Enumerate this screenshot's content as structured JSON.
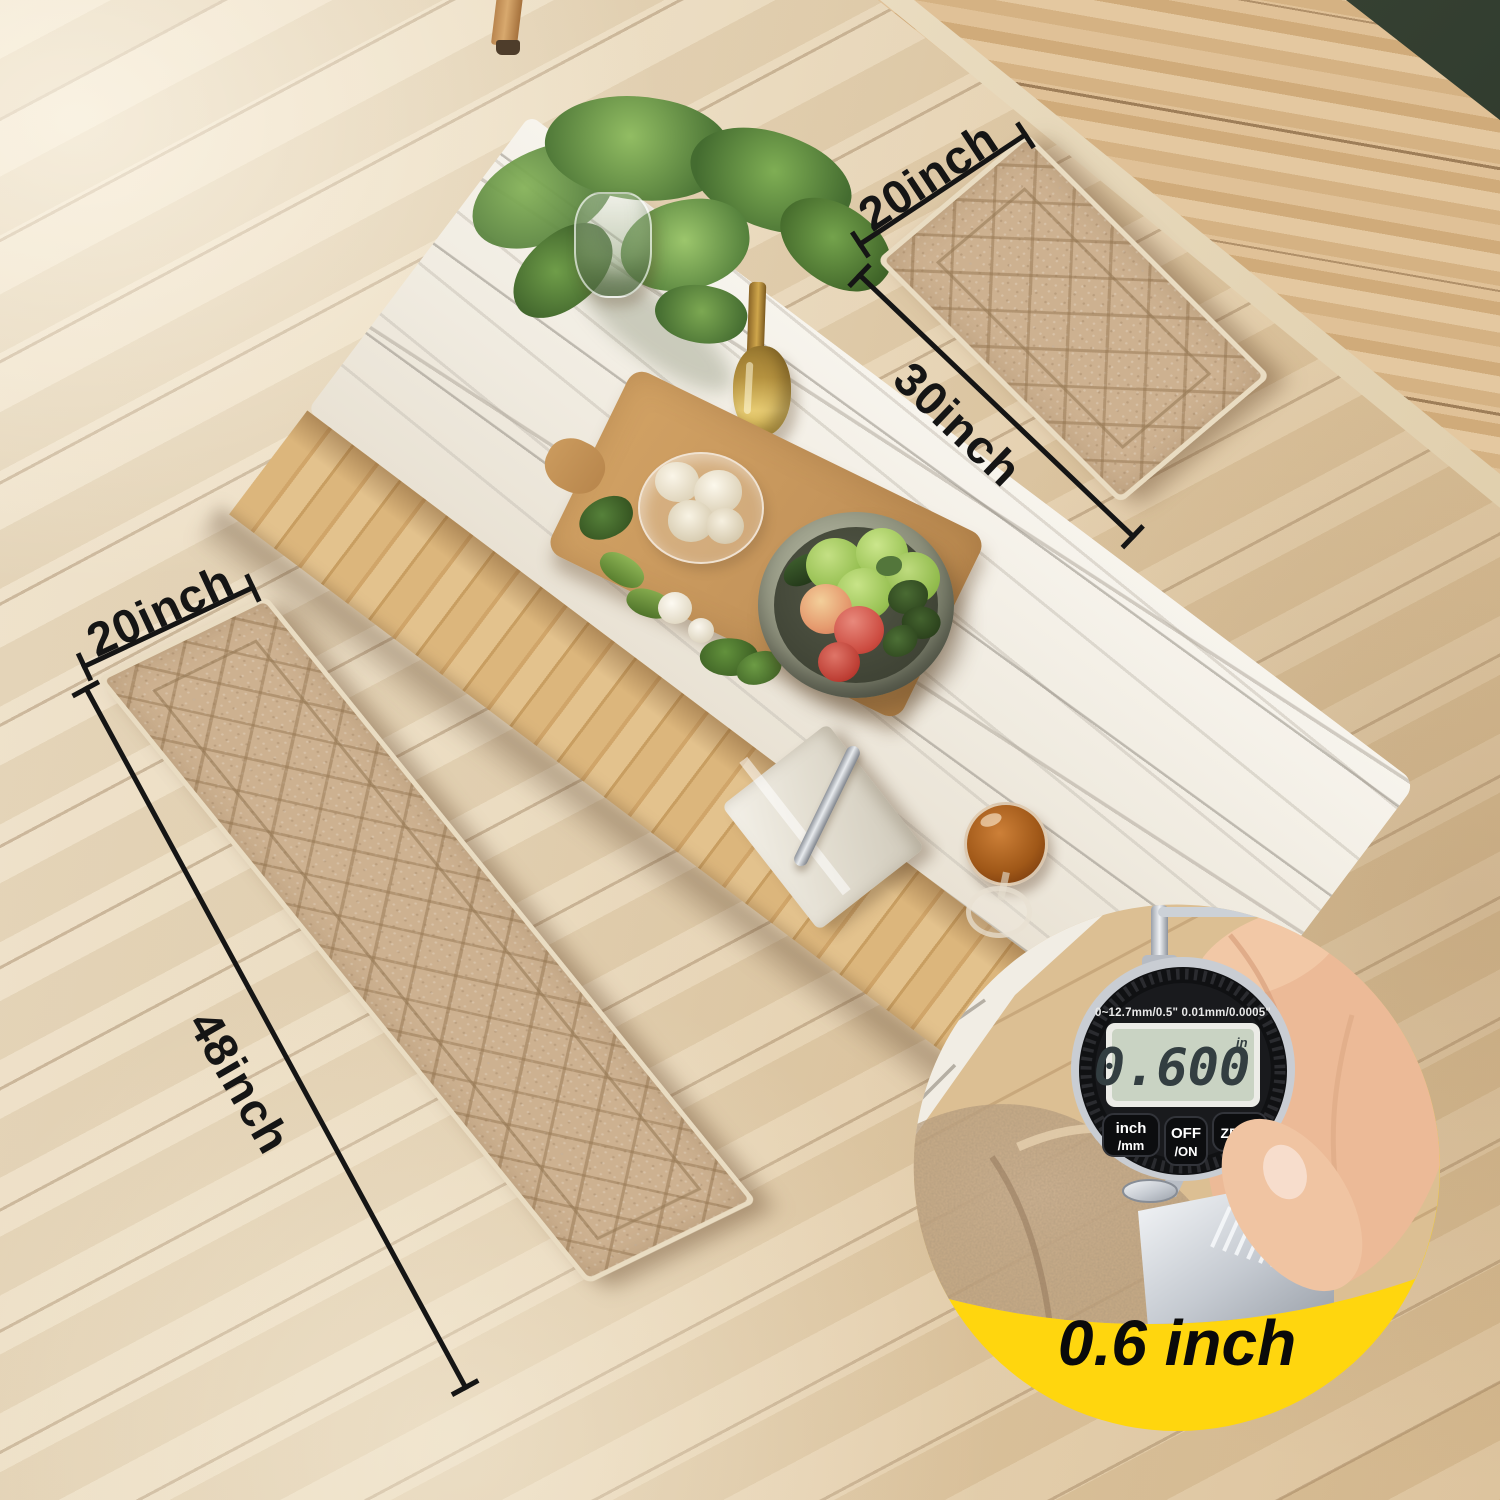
{
  "annotations": {
    "door_mat": {
      "width_label": "20inch",
      "length_label": "30inch"
    },
    "runner_mat": {
      "width_label": "20inch",
      "length_label": "48inch"
    }
  },
  "badge": {
    "thickness_label": "0.6 inch"
  },
  "gauge": {
    "spec_text": "0~12.7mm/0.5\" 0.01mm/0.0005\"",
    "display_value": "0.600",
    "display_unit": "in",
    "btn_inch_line1": "inch",
    "btn_inch_line2": "/mm",
    "btn_off_line1": "OFF",
    "btn_off_line2": "/ON",
    "btn_zero": "ZERO"
  },
  "colors": {
    "badge_yellow": "#FFD60E",
    "annotation_ink": "#151515",
    "mat_beige": "#CDB190",
    "lcd_screen": "#C9D3C3",
    "marble_white": "#F2EEE5",
    "floor_wood": "#E6D3B2",
    "cabinet_wood": "#DCBD93"
  }
}
